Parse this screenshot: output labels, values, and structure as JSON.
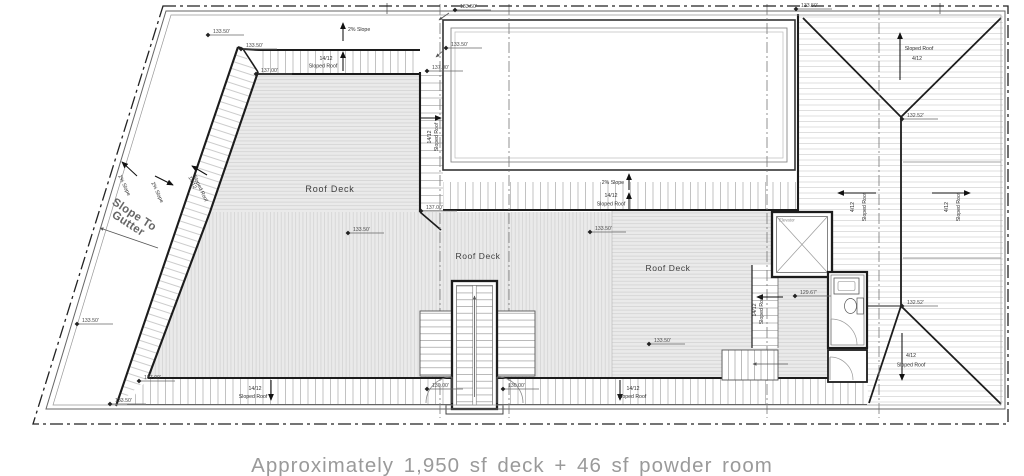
{
  "caption": "Approximately 1,950 sf deck + 46 sf powder room",
  "labels": {
    "roof_deck": "Roof Deck",
    "slope_to_gutter_1": "Slope To",
    "slope_to_gutter_2": "Gutter",
    "pct_slope": "2% Slope",
    "ratio_14_12": "14/12",
    "sloped_roof": "Sloped Roof",
    "ratio_4_12": "4/12",
    "elevator": "Elevator"
  },
  "elevations": [
    {
      "x": 208,
      "y": 35,
      "v": "133.50'"
    },
    {
      "x": 241,
      "y": 49,
      "v": "133.50'"
    },
    {
      "x": 256,
      "y": 74,
      "v": "137.00'"
    },
    {
      "x": 455,
      "y": 10,
      "v": "133.50'"
    },
    {
      "x": 446,
      "y": 48,
      "v": "133.50'"
    },
    {
      "x": 427,
      "y": 71,
      "v": "137.00'"
    },
    {
      "x": 421,
      "y": 211,
      "v": "137.00'"
    },
    {
      "x": 796,
      "y": 9,
      "v": "133.50'"
    },
    {
      "x": 902,
      "y": 119,
      "v": "132.52'"
    },
    {
      "x": 902,
      "y": 306,
      "v": "132.52'"
    },
    {
      "x": 77,
      "y": 324,
      "v": "133.50'"
    },
    {
      "x": 348,
      "y": 233,
      "v": "133.50'"
    },
    {
      "x": 590,
      "y": 232,
      "v": "133.50'"
    },
    {
      "x": 649,
      "y": 344,
      "v": "133.50'"
    },
    {
      "x": 795,
      "y": 296,
      "v": "129.67'"
    },
    {
      "x": 427,
      "y": 389,
      "v": "130.00'"
    },
    {
      "x": 503,
      "y": 389,
      "v": "130.00'"
    },
    {
      "x": 139,
      "y": 381,
      "v": "137.00'"
    },
    {
      "x": 110,
      "y": 404,
      "v": "133.50'"
    }
  ],
  "arrows": [
    {
      "x1": 343,
      "y1": 41,
      "x2": 343,
      "y2": 23,
      "k": "b"
    },
    {
      "x1": 343,
      "y1": 71,
      "x2": 343,
      "y2": 52,
      "k": "b"
    },
    {
      "x1": 629,
      "y1": 190,
      "x2": 629,
      "y2": 174,
      "k": "b"
    },
    {
      "x1": 629,
      "y1": 209,
      "x2": 629,
      "y2": 193,
      "k": "b"
    },
    {
      "x1": 421,
      "y1": 118,
      "x2": 441,
      "y2": 118,
      "k": "b"
    },
    {
      "x1": 900,
      "y1": 80,
      "x2": 900,
      "y2": 33,
      "k": "b"
    },
    {
      "x1": 876,
      "y1": 193,
      "x2": 838,
      "y2": 193,
      "k": "b"
    },
    {
      "x1": 932,
      "y1": 193,
      "x2": 970,
      "y2": 193,
      "k": "b"
    },
    {
      "x1": 902,
      "y1": 333,
      "x2": 902,
      "y2": 380,
      "k": "b"
    },
    {
      "x1": 783,
      "y1": 297,
      "x2": 757,
      "y2": 297,
      "k": "b"
    },
    {
      "x1": 271,
      "y1": 380,
      "x2": 271,
      "y2": 400,
      "k": "b"
    },
    {
      "x1": 620,
      "y1": 380,
      "x2": 620,
      "y2": 400,
      "k": "b"
    },
    {
      "x1": 137,
      "y1": 176,
      "x2": 122,
      "y2": 162,
      "k": "b"
    },
    {
      "x1": 155,
      "y1": 176,
      "x2": 173,
      "y2": 185,
      "k": "b"
    },
    {
      "x1": 207,
      "y1": 175,
      "x2": 192,
      "y2": 166,
      "k": "b"
    },
    {
      "x1": 158,
      "y1": 248,
      "x2": 100,
      "y2": 228,
      "k": "t"
    },
    {
      "x1": 474.5,
      "y1": 397,
      "x2": 474.5,
      "y2": 296,
      "k": "t"
    },
    {
      "x1": 788,
      "y1": 364,
      "x2": 753,
      "y2": 364,
      "k": "t"
    },
    {
      "x1": 449,
      "y1": 13,
      "x2": 439,
      "y2": 20,
      "k": "t"
    },
    {
      "x1": 444,
      "y1": 50,
      "x2": 436,
      "y2": 57,
      "k": "t"
    }
  ]
}
